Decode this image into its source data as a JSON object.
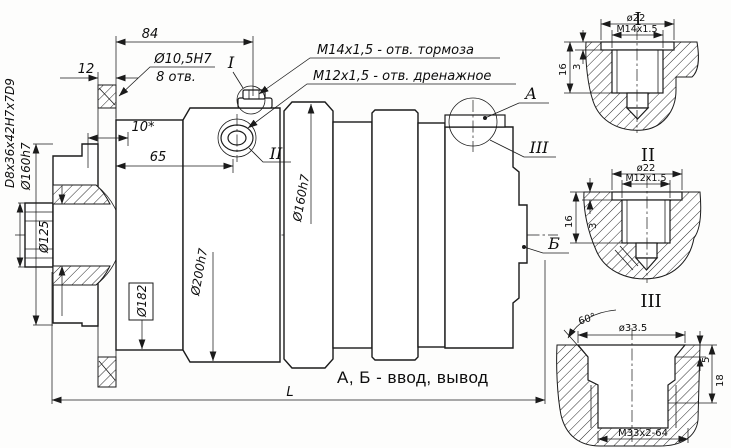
{
  "drawing_type": "engineering-section-drawing",
  "colors": {
    "line": "#1b1b1b",
    "background": "#fdfdfc"
  },
  "main": {
    "dim_84": "84",
    "dim_12": "12",
    "dim_10": "10*",
    "dim_65": "65",
    "holes_dia": "Ø10,5H7",
    "holes_count": "8 отв.",
    "brake_callout": "M14x1,5 -  отв. тормоза",
    "drain_callout": "M12x1,5 -  отв. дренажное",
    "spline": "D8x36x42H7x7D9",
    "dia_160_left": "Ø160h7",
    "dia_125": "Ø125",
    "dia_182": "Ø182",
    "dia_200": "Ø200h7",
    "dia_160_right": "Ø160h7",
    "length": "L",
    "ref_i": "I",
    "ref_ii": "II",
    "ref_iii": "III",
    "port_a": "А",
    "port_b": "Б",
    "note": "А, Б - ввод, вывод"
  },
  "details": {
    "i": {
      "title": "I",
      "dia": "ø22",
      "thread": "M14x1.5",
      "d16": "16",
      "d3": "3"
    },
    "ii": {
      "title": "II",
      "dia": "ø22",
      "thread": "M12x1.5",
      "d16": "16",
      "d3": "3"
    },
    "iii": {
      "title": "III",
      "angle": "60°",
      "dia": "ø33.5",
      "d5": "5",
      "d18": "18",
      "thread": "M33x2-64"
    }
  }
}
